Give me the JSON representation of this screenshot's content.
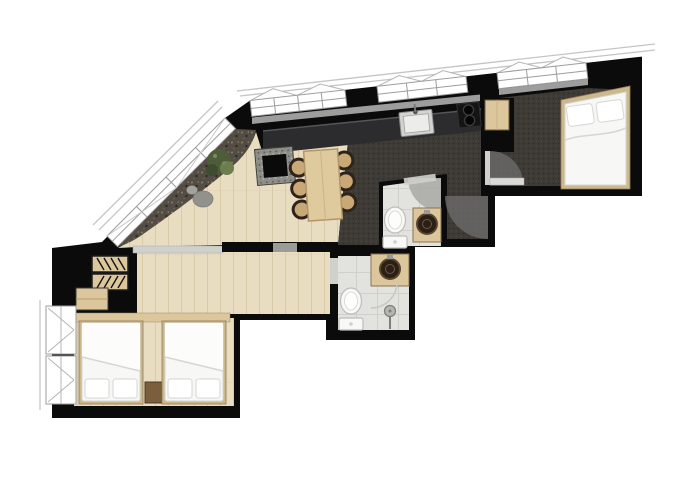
{
  "meta": {
    "type": "apartment-floor-plan"
  },
  "colors": {
    "background": "#ffffff",
    "wall": "#0b0b0b",
    "wood": "#e9ddc1",
    "wood_line": "#d8c9a6",
    "wood_furn": "#dcc79c",
    "wood_furn_edge": "#8a7350",
    "carpet": "#3e3a35",
    "carpet_dl": "#4c4741",
    "carpet_dd": "#2b2824",
    "gravel": "#544d44",
    "gravel_l": "#8a7e6d",
    "gravel_d": "#2d2923",
    "tile": "#e2e2df",
    "tile_line": "#cbcbc8",
    "fixture": "#f8f8f6",
    "fixture_line": "#bcbcb9",
    "counter": "#2c2c2e",
    "counter_edge": "#56565a",
    "steel": "#d3d3d1",
    "basin": "#2a2016",
    "basin_edge": "#5a4630",
    "arc": "#6c6c6a",
    "arc_l": "#a8a8a5",
    "winframe": "#9c9c9c",
    "roofline": "#c5c5c5",
    "ledge": "#9d9d9d",
    "plant": "#4e5c39",
    "plant_l": "#6d7d4d",
    "stone": "#92928c",
    "tablewood": "#dfca9e",
    "tableedge": "#b4956a",
    "chairseat": "#c9a877",
    "chairrim": "#2e2318",
    "bedframe": "#cdb88e",
    "duvet": "#f7f7f6",
    "duvet_line": "#d6d6d2",
    "sill": "#d0d0cd",
    "nightstand": "#7b5e3b",
    "cooktop": "#141414",
    "burner": "#060606"
  },
  "counts": {
    "beds": 3,
    "bed_pillows": 6,
    "dining_chairs": 6,
    "dining_tables": 1,
    "toilets": 2,
    "washbasins": 2,
    "kitchen_sinks": 1,
    "cooktop_burners": 2,
    "door_swing_arcs": 3,
    "shower_heads": 1,
    "fireplaces": 1,
    "plants": 1,
    "wardrobes": 1,
    "roof_window_groups": 3
  }
}
